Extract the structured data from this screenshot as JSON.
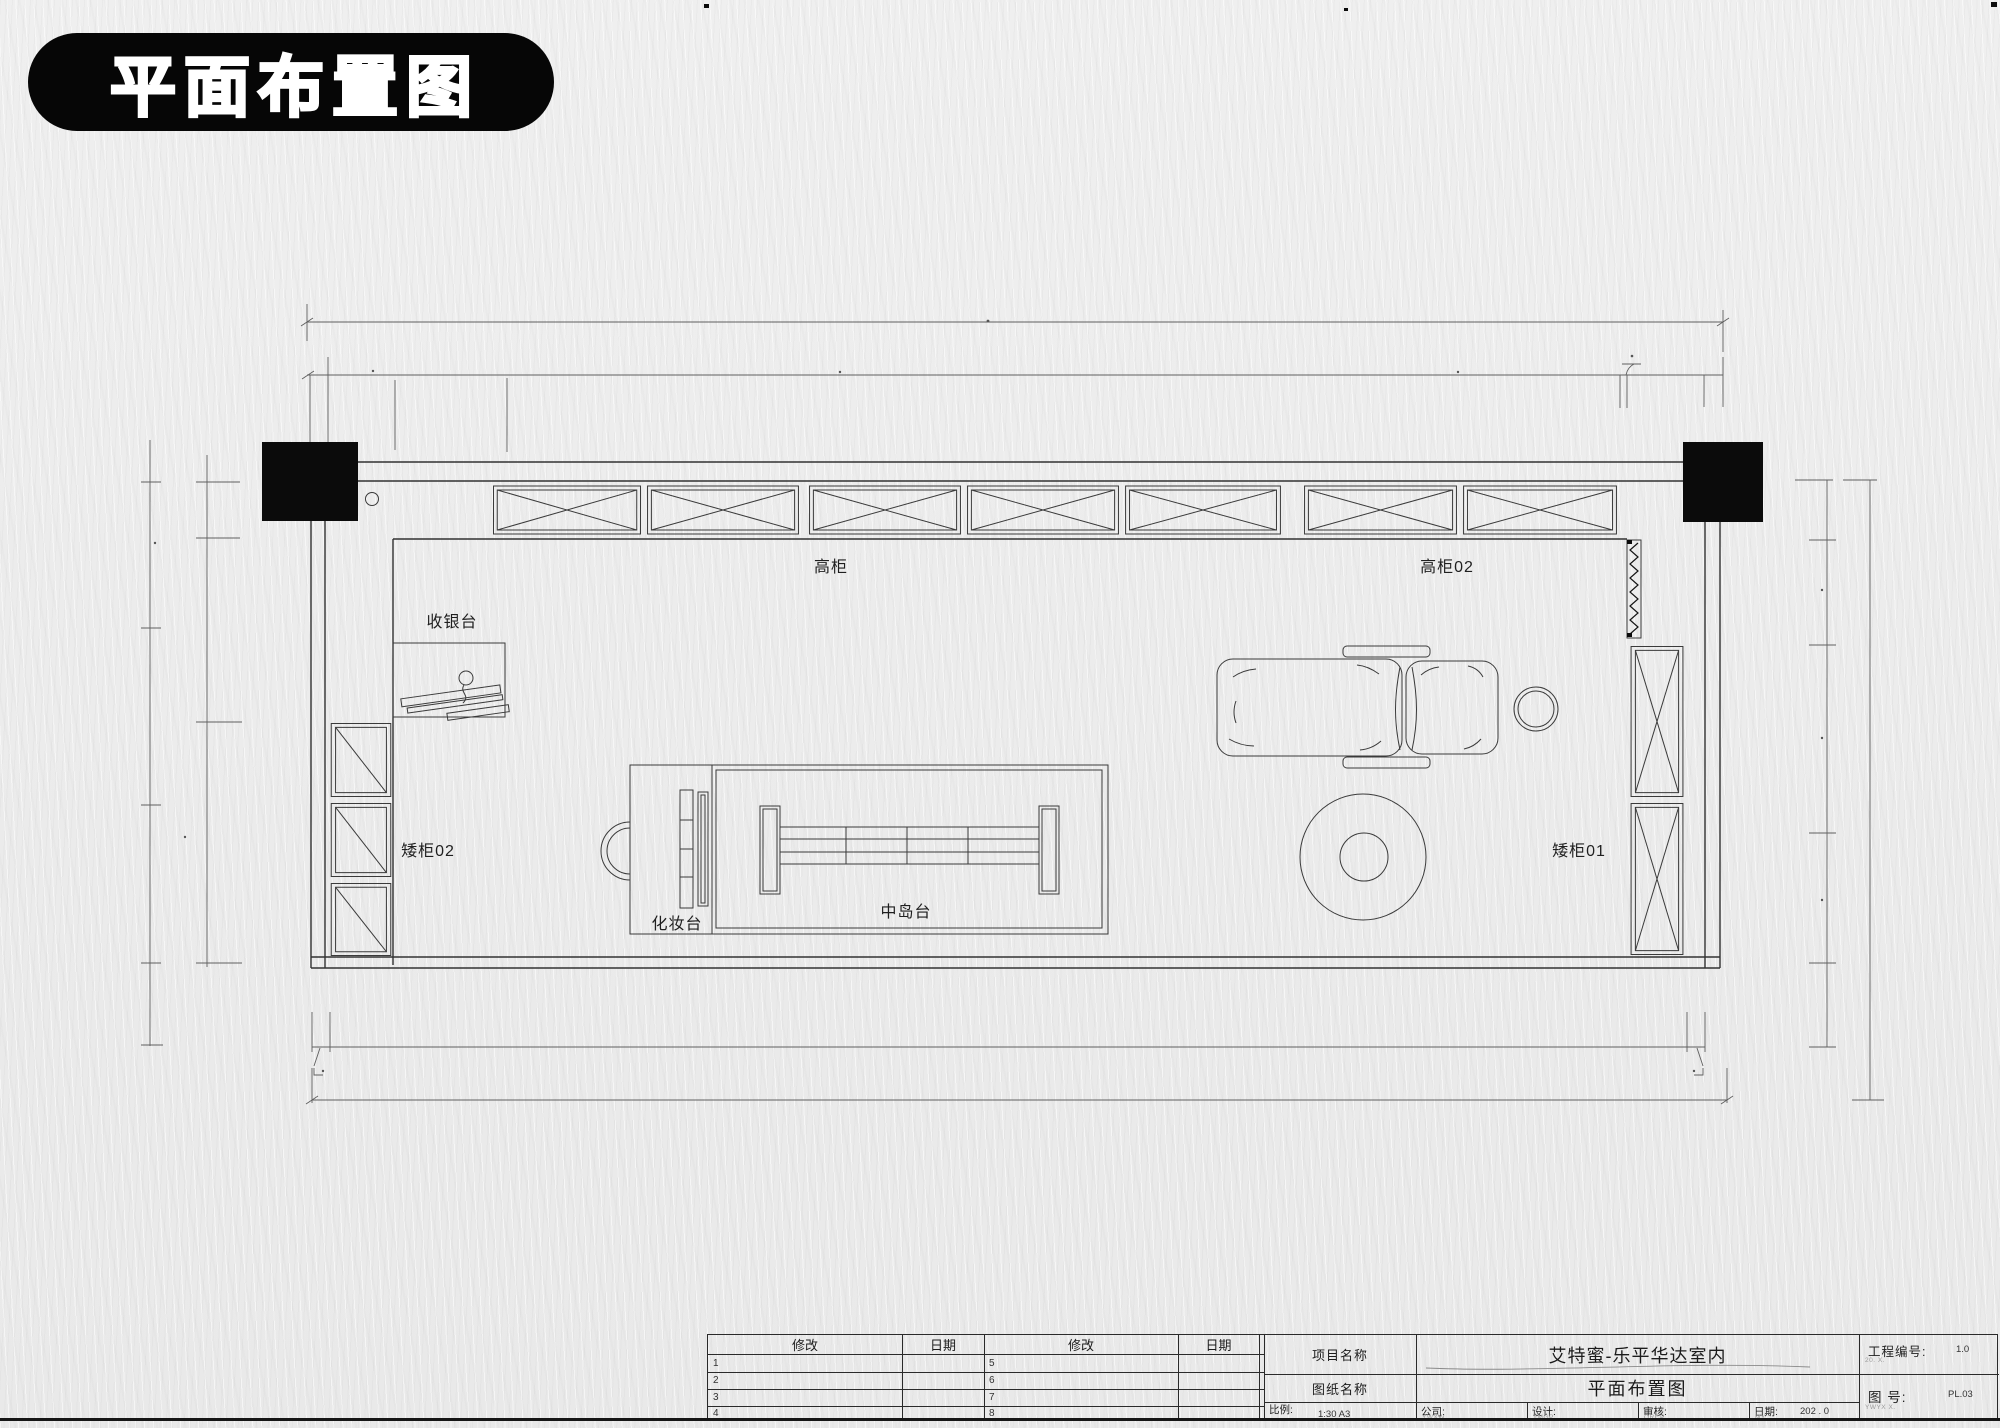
{
  "title_badge": {
    "text": "平面布置图"
  },
  "plan": {
    "labels": {
      "tall_cabinet": "高柜",
      "tall_cabinet_02": "高柜02",
      "cashier_counter": "收银台",
      "low_cabinet_02": "矮柜02",
      "low_cabinet_01": "矮柜01",
      "dressing_table": "化妆台",
      "center_island": "中岛台"
    }
  },
  "title_block": {
    "rev_col_modify": "修改",
    "rev_col_date": "日期",
    "rev_rows": [
      {
        "no_left": "1",
        "no_right": "5"
      },
      {
        "no_left": "2",
        "no_right": "6"
      },
      {
        "no_left": "3",
        "no_right": "7"
      },
      {
        "no_left": "4",
        "no_right": "8"
      }
    ],
    "project_name_label": "项目名称",
    "project_name_value": "艾特蜜-乐平华达室内",
    "sheet_name_label": "图纸名称",
    "sheet_name_value": "平面布置图",
    "scale_label": "比例:",
    "scale_value": "1:30 A3",
    "company_label": "公司:",
    "company_sub": "YWXW",
    "design_label": "设计:",
    "design_sub": "TMGP",
    "review_label": "审核:",
    "review_sub": "ORCP",
    "date_label": "日期:",
    "date_value": "202 . 0",
    "date_sub": "MY",
    "project_no_label": "工程编号:",
    "project_no_value": "1.0",
    "project_no_sub": "20. X.",
    "drawing_no_label": "图 号:",
    "drawing_no_value": "PL.03",
    "drawing_no_sub": "YWYX X."
  },
  "colors": {
    "paper": "#ececec",
    "line": "#3a3a3a",
    "ink": "#0b0b0b"
  }
}
